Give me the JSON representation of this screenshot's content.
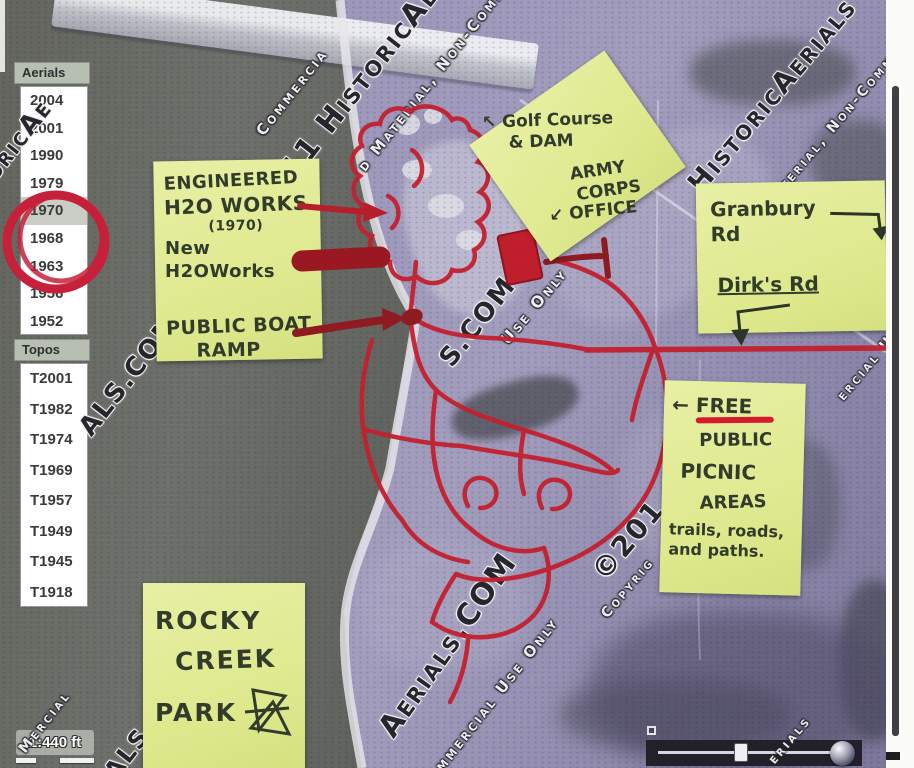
{
  "viewer": {
    "sidebar": {
      "aerials_header": "Aerials",
      "aerial_years": [
        "2004",
        "2001",
        "1990",
        "1979",
        "1970",
        "1968",
        "1963",
        "1956",
        "1952"
      ],
      "selected_aerial_year": "1970",
      "topos_header": "Topos",
      "topo_years": [
        "T2001",
        "T1982",
        "T1974",
        "T1969",
        "T1957",
        "T1949",
        "T1945",
        "T1918"
      ]
    },
    "map_controls": {
      "scale_label": "1:440 ft"
    }
  },
  "annotations": {
    "waterworks_note": {
      "line1": "ENGINEERED",
      "line2": "H2O WORKS",
      "line3": "(1970)",
      "line4": "New H2OWorks",
      "line5": "PUBLIC BOAT",
      "line6": "RAMP"
    },
    "golf_note": {
      "line1": "↖ Golf Course",
      "line2": "& DAM",
      "line3": "ARMY",
      "line4": "CORPS",
      "line5": "↙ OFFICE"
    },
    "roads_note": {
      "line1": "Granbury Rd",
      "line2": "Dirk's Rd"
    },
    "picnic_note": {
      "line1": "← FREE",
      "line2": "PUBLIC",
      "line3": "PICNIC",
      "line4": "AREAS",
      "line5": "trails, roads,",
      "line6": "and paths."
    },
    "park_note": {
      "line1": "ROCKY",
      "line2": "CREEK",
      "line3": "PARK"
    },
    "circled_year": "1970",
    "marker_color": "#c2202e",
    "marker_dark_color": "#8e1a22",
    "note_color": "#e0ea92"
  },
  "watermarks": {
    "a": "©2011 HistoricAeria",
    "b": "oricAe",
    "c": "d Material, Non-Commercia",
    "d": "HistoricAerials",
    "e": "terial, Non-Commercial",
    "f": "ALS.COM",
    "g": "S.COM",
    "h": "Use Only",
    "i": "Aerials.COM",
    "j": "mmercial Use Only",
    "k": "©201",
    "l": "Copyrig",
    "m": "ercial U",
    "n": "Mercial",
    "o": "IALS.CO",
    "p": "Mercial",
    "q": "erials",
    "r": "Commercia"
  }
}
